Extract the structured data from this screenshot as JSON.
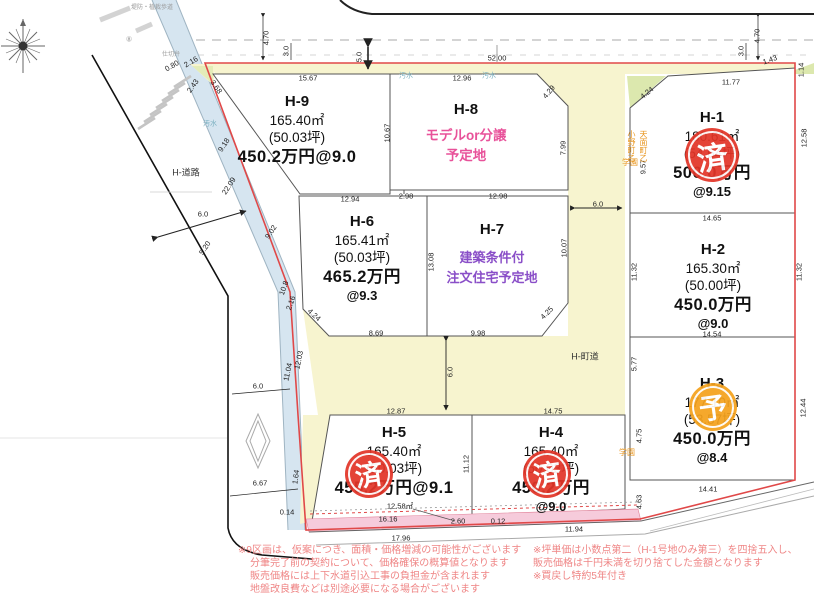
{
  "lots": [
    {
      "id": "H-9",
      "area": "165.40㎡",
      "tsubo": "(50.03坪)",
      "price": "450.2万円@9.0",
      "rate": "",
      "note1": "",
      "note2": ""
    },
    {
      "id": "H-8",
      "area": "",
      "tsubo": "",
      "price": "",
      "rate": "",
      "note1": "モデルor分譲",
      "note2": "予定地"
    },
    {
      "id": "H-6",
      "area": "165.41㎡",
      "tsubo": "(50.03坪)",
      "price": "465.2万円",
      "rate": "@9.3",
      "note1": "",
      "note2": ""
    },
    {
      "id": "H-7",
      "area": "",
      "tsubo": "",
      "price": "",
      "rate": "",
      "note1": "建築条件付",
      "note2": "注文住宅予定地"
    },
    {
      "id": "H-1",
      "area": "180.61㎡",
      "tsubo": "(54.64坪)",
      "price": "500.0万円",
      "rate": "@9.15",
      "note1": "",
      "note2": ""
    },
    {
      "id": "H-2",
      "area": "165.30㎡",
      "tsubo": "(50.00坪)",
      "price": "450.0万円",
      "rate": "@9.0",
      "note1": "",
      "note2": ""
    },
    {
      "id": "H-3",
      "area": "177.10㎡",
      "tsubo": "(53.57坪)",
      "price": "450.0万円",
      "rate": "@8.4",
      "note1": "",
      "note2": ""
    },
    {
      "id": "H-5",
      "area": "165.40㎡",
      "tsubo": "(50.03坪)",
      "price": "455.2万円@9.1",
      "rate": "",
      "note1": "",
      "note2": ""
    },
    {
      "id": "H-4",
      "area": "165.40㎡",
      "tsubo": "(50.03坪)",
      "price": "450.2万円",
      "rate": "@9.0",
      "note1": "",
      "note2": ""
    }
  ],
  "stamps": [
    {
      "glyph": "済",
      "x": 712,
      "y": 155,
      "r": 27,
      "color": "#e23528"
    },
    {
      "glyph": "済",
      "x": 369,
      "y": 474,
      "r": 24,
      "color": "#e23528"
    },
    {
      "glyph": "済",
      "x": 547,
      "y": 474,
      "r": 24,
      "color": "#e23528"
    },
    {
      "glyph": "予",
      "x": 713,
      "y": 407,
      "r": 24,
      "color": "#f5a21d"
    }
  ],
  "dims": [
    {
      "t": "5.0",
      "x": 359,
      "y": 57,
      "r": -90
    },
    {
      "t": "4.70",
      "x": 266,
      "y": 38,
      "r": -90
    },
    {
      "t": "3.0",
      "x": 286,
      "y": 51,
      "r": -90
    },
    {
      "t": "4.70",
      "x": 757,
      "y": 36,
      "r": -90
    },
    {
      "t": "3.0",
      "x": 741,
      "y": 51,
      "r": -90
    },
    {
      "t": "52.00",
      "x": 497,
      "y": 58
    },
    {
      "t": "15.67",
      "x": 308,
      "y": 78
    },
    {
      "t": "12.96",
      "x": 462,
      "y": 78
    },
    {
      "t": "11.77",
      "x": 731,
      "y": 82
    },
    {
      "t": "1.43",
      "x": 770,
      "y": 60,
      "r": -20
    },
    {
      "t": "1.14",
      "x": 801,
      "y": 70,
      "r": -90
    },
    {
      "t": "4.24",
      "x": 647,
      "y": 93,
      "r": -40
    },
    {
      "t": "4.29",
      "x": 549,
      "y": 92,
      "r": -50
    },
    {
      "t": "9.57",
      "x": 643,
      "y": 167,
      "r": -90
    },
    {
      "t": "10.67",
      "x": 387,
      "y": 133,
      "r": -90
    },
    {
      "t": "7.99",
      "x": 563,
      "y": 148,
      "r": -90
    },
    {
      "t": "12.58",
      "x": 804,
      "y": 138,
      "r": -90
    },
    {
      "t": "12.94",
      "x": 350,
      "y": 199
    },
    {
      "t": "2.98",
      "x": 406,
      "y": 196
    },
    {
      "t": "12.98",
      "x": 498,
      "y": 196
    },
    {
      "t": "6.0",
      "x": 598,
      "y": 204
    },
    {
      "t": "14.65",
      "x": 712,
      "y": 218
    },
    {
      "t": "11.32",
      "x": 634,
      "y": 272,
      "r": -90
    },
    {
      "t": "11.32",
      "x": 799,
      "y": 272,
      "r": -90
    },
    {
      "t": "13.08",
      "x": 431,
      "y": 262,
      "r": -90
    },
    {
      "t": "10.07",
      "x": 564,
      "y": 248,
      "r": -90
    },
    {
      "t": "9.18",
      "x": 224,
      "y": 145,
      "r": -57
    },
    {
      "t": "22.09",
      "x": 229,
      "y": 186,
      "r": -57
    },
    {
      "t": "6.0",
      "x": 203,
      "y": 214
    },
    {
      "t": "5.20",
      "x": 205,
      "y": 248,
      "r": -57
    },
    {
      "t": "9.02",
      "x": 271,
      "y": 232,
      "r": -57
    },
    {
      "t": "10.8",
      "x": 284,
      "y": 288,
      "r": -70
    },
    {
      "t": "2.16",
      "x": 291,
      "y": 303,
      "r": -70
    },
    {
      "t": "4.24",
      "x": 314,
      "y": 315,
      "r": 42
    },
    {
      "t": "8.69",
      "x": 376,
      "y": 333
    },
    {
      "t": "9.98",
      "x": 478,
      "y": 333
    },
    {
      "t": "4.25",
      "x": 547,
      "y": 313,
      "r": -45
    },
    {
      "t": "14.54",
      "x": 712,
      "y": 334
    },
    {
      "t": "5.77",
      "x": 634,
      "y": 364,
      "r": -90
    },
    {
      "t": "6.0",
      "x": 450,
      "y": 372,
      "r": -90
    },
    {
      "t": "12.87",
      "x": 396,
      "y": 411
    },
    {
      "t": "14.75",
      "x": 553,
      "y": 411
    },
    {
      "t": "11.04",
      "x": 288,
      "y": 372,
      "r": -78
    },
    {
      "t": "12.03",
      "x": 299,
      "y": 360,
      "r": -78
    },
    {
      "t": "6.0",
      "x": 258,
      "y": 386
    },
    {
      "t": "6.67",
      "x": 260,
      "y": 483
    },
    {
      "t": "1.64",
      "x": 296,
      "y": 477,
      "r": -82
    },
    {
      "t": "11.12",
      "x": 466,
      "y": 464,
      "r": -90
    },
    {
      "t": "12.44",
      "x": 803,
      "y": 408,
      "r": -90
    },
    {
      "t": "4.75",
      "x": 639,
      "y": 436,
      "r": -90
    },
    {
      "t": "4.63",
      "x": 639,
      "y": 502,
      "r": -90
    },
    {
      "t": "14.41",
      "x": 708,
      "y": 489
    },
    {
      "t": "12.58㎡",
      "x": 400,
      "y": 506
    },
    {
      "t": "16.16",
      "x": 388,
      "y": 519
    },
    {
      "t": "17.96",
      "x": 401,
      "y": 538
    },
    {
      "t": "2.60",
      "x": 458,
      "y": 521
    },
    {
      "t": "0.12",
      "x": 498,
      "y": 521
    },
    {
      "t": "11.94",
      "x": 574,
      "y": 529
    },
    {
      "t": "0.14",
      "x": 287,
      "y": 512
    },
    {
      "t": "0.80",
      "x": 172,
      "y": 66,
      "r": -30
    },
    {
      "t": "2.16",
      "x": 191,
      "y": 62,
      "r": -30
    },
    {
      "t": "3.68",
      "x": 216,
      "y": 87,
      "r": 55
    },
    {
      "t": "2.43",
      "x": 193,
      "y": 86,
      "r": -55
    }
  ],
  "map_labels": [
    {
      "t": "H-道路",
      "x": 186,
      "y": 173,
      "c": "#333",
      "s": 9
    },
    {
      "t": "H-町道",
      "x": 585,
      "y": 357,
      "c": "#333",
      "s": 9
    },
    {
      "t": "汚水",
      "x": 406,
      "y": 76,
      "c": "#7ab0c0",
      "s": 7
    },
    {
      "t": "汚水",
      "x": 489,
      "y": 76,
      "c": "#7ab0c0",
      "s": 7
    },
    {
      "t": "汚水",
      "x": 210,
      "y": 124,
      "c": "#7ab0c0",
      "s": 7
    },
    {
      "t": "小野町乙",
      "x": 631,
      "y": 130,
      "c": "#e8951d",
      "s": 8,
      "vert": true
    },
    {
      "t": "天面町乙",
      "x": 643,
      "y": 130,
      "c": "#e8951d",
      "s": 8,
      "vert": true
    },
    {
      "t": "学園",
      "x": 630,
      "y": 163,
      "c": "#e8951d",
      "s": 8
    },
    {
      "t": "学園",
      "x": 627,
      "y": 453,
      "c": "#e8951d",
      "s": 8
    },
    {
      "t": "堤防・植栽歩道",
      "x": 152,
      "y": 8,
      "c": "#999",
      "s": 6
    },
    {
      "t": "仕切弁",
      "x": 171,
      "y": 55,
      "c": "#999",
      "s": 6
    },
    {
      "t": "⑧",
      "x": 129,
      "y": 40,
      "c": "#999",
      "s": 7
    }
  ],
  "notes_left": [
    "※9区画は、仮案につき、面積・価格増減の可能性がございます",
    "分筆完了前の契約について、価格確保の概算値となります",
    "販売価格には上下水道引込工事の負担金が含まれます",
    "地盤改良費などは別途必要になる場合がございます"
  ],
  "notes_right": [
    "※坪単価は小数点第二（H-1号地のみ第三）を四捨五入し、",
    "販売価格は千円未満を切り捨てした金額となります",
    "※買戻し特約5年付き"
  ],
  "colors": {
    "road_yellow": "#f7f4cf",
    "road_blue": "#d6e5f0",
    "green_wedge": "#dce8ae",
    "pink_strip": "#f6cbdb",
    "boundary_red": "#e04848",
    "stamp_red": "#e23528",
    "stamp_orange": "#f5a21d",
    "text_pink": "#e8529a",
    "text_purple": "#8a4fc8",
    "notes_red": "#ef8585"
  }
}
